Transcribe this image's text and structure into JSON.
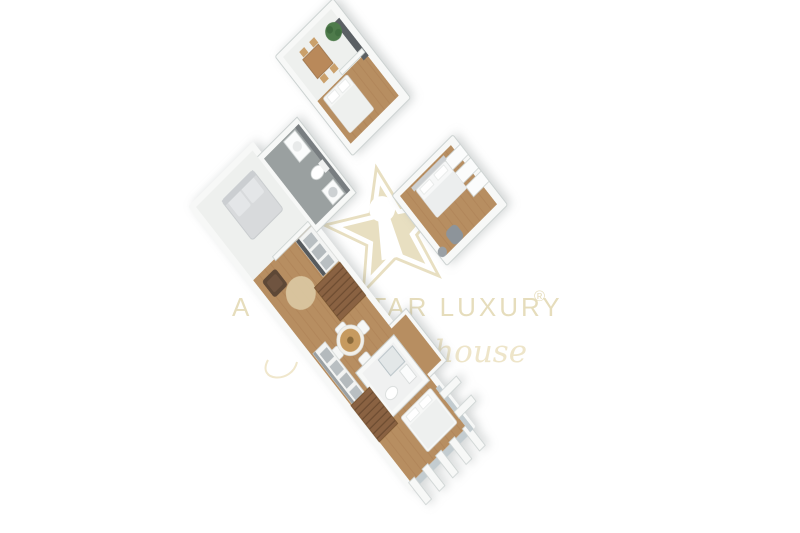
{
  "canvas": {
    "width": 800,
    "height": 533,
    "background": "#ffffff"
  },
  "watermark": {
    "brand_visible": "STAR LUXURY",
    "brand_partial_left": "A",
    "registered_mark": "®",
    "tagline_visible": "ry house",
    "logo": "star-keyhole",
    "brand_color": "#e6ddbc",
    "tagline_color": "#eee5c9",
    "star_fill": "#e8dfc1",
    "star_inner_outline": "#ffffff"
  },
  "floor_plan": {
    "type": "3d-axonometric-floor-plan",
    "units": [
      {
        "id": "top-studio",
        "rooms": [
          "dining-area",
          "sleeping-area"
        ],
        "furniture": [
          "dining-table",
          "wood-chairs",
          "potted-plant",
          "double-bed"
        ],
        "accent_wall_color": "#5b6064"
      },
      {
        "id": "bedroom-unit",
        "rooms": [
          "bedroom"
        ],
        "furniture": [
          "double-bed",
          "wardrobe-shelves",
          "gray-armchair",
          "pouf"
        ]
      },
      {
        "id": "main-duplex",
        "rooms": [
          "lounge",
          "upper-bathroom",
          "living-room",
          "kitchen",
          "dining-area",
          "second-kitchen",
          "lower-shower-room",
          "lower-bedroom"
        ],
        "furniture": [
          "sofa",
          "sink-vanity",
          "toilet",
          "washing-machine",
          "dark-armchair",
          "round-rug",
          "kitchen-counter",
          "staircase-upper",
          "round-dining-table",
          "white-chairs",
          "counter-run",
          "shower",
          "staircase-lower",
          "bed"
        ],
        "features": [
          "window-pillars",
          "glass-panels"
        ]
      }
    ],
    "palette": {
      "wood_floor": "#b78e61",
      "plank_line": "#a87b50",
      "wall": "#f7f8f7",
      "wall_edge": "#ccd2d1",
      "tile_floor": "#eef0ee",
      "bath_floor": "#9aa0a0",
      "stairs": "#8a6242",
      "stair_line": "#6d4c31",
      "sofa": "#d8dadc",
      "appliance": "#b9bfc2",
      "plant": "#4e7b4b",
      "rug": "#d9c6a0",
      "table_wood": "#c69a5f",
      "chair_gray": "#8d949a",
      "accent_wall": "#5b6064",
      "glass": "#c3ccd0"
    }
  }
}
